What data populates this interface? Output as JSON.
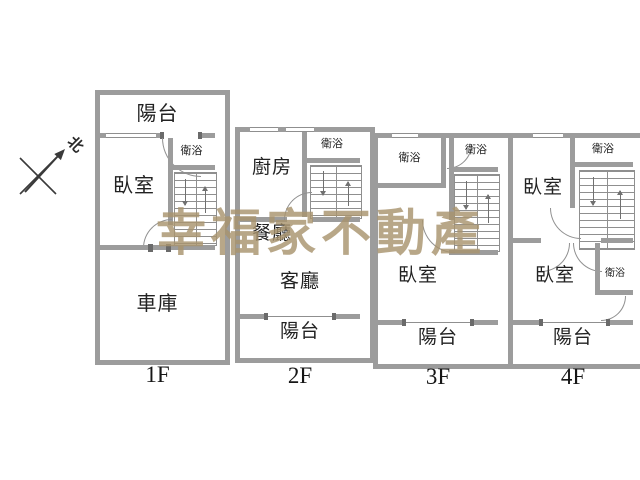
{
  "compass": {
    "label": "北"
  },
  "watermark": {
    "text": "幸福家不動產"
  },
  "colors": {
    "wall": "#9c9c9c",
    "line": "#8f8f8f",
    "text": "#222222",
    "watermark": "#a8946e"
  },
  "floors": {
    "f1": {
      "label": "1F",
      "balcony": "陽台",
      "bedroom": "臥室",
      "bath": "衛浴",
      "garage": "車庫"
    },
    "f2": {
      "label": "2F",
      "kitchen": "廚房",
      "bath": "衛浴",
      "dining": "餐廳",
      "living": "客廳",
      "balcony": "陽台"
    },
    "f3": {
      "label": "3F",
      "bath_left": "衛浴",
      "bath_right": "衛浴",
      "bedroom": "臥室",
      "balcony": "陽台"
    },
    "f4": {
      "label": "4F",
      "bedroom_top": "臥室",
      "bath_top": "衛浴",
      "bedroom_bottom": "臥室",
      "bath_bottom": "衛浴",
      "balcony": "陽台"
    }
  }
}
